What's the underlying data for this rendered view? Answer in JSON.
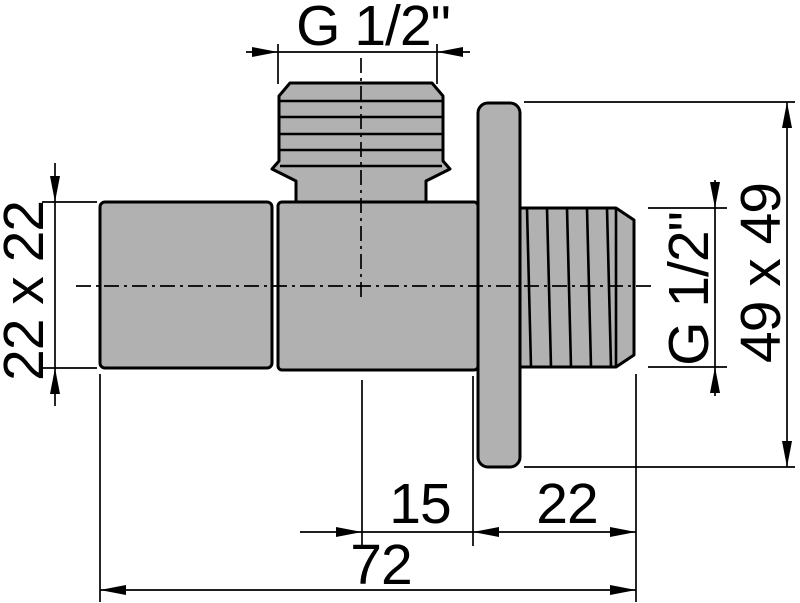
{
  "drawing": {
    "type": "technical-drawing",
    "subject": "angle-valve-side-view",
    "colors": {
      "background": "#ffffff",
      "part_fill": "#b1b1b1",
      "line": "#000000"
    },
    "labels": {
      "top_thread": "G 1/2\"",
      "left_body_size": "22 x 22",
      "right_thread": "G 1/2\"",
      "plate_size": "49 x 49",
      "center_to_wall": "15",
      "wall_stub_length": "22",
      "total_length": "72"
    }
  }
}
